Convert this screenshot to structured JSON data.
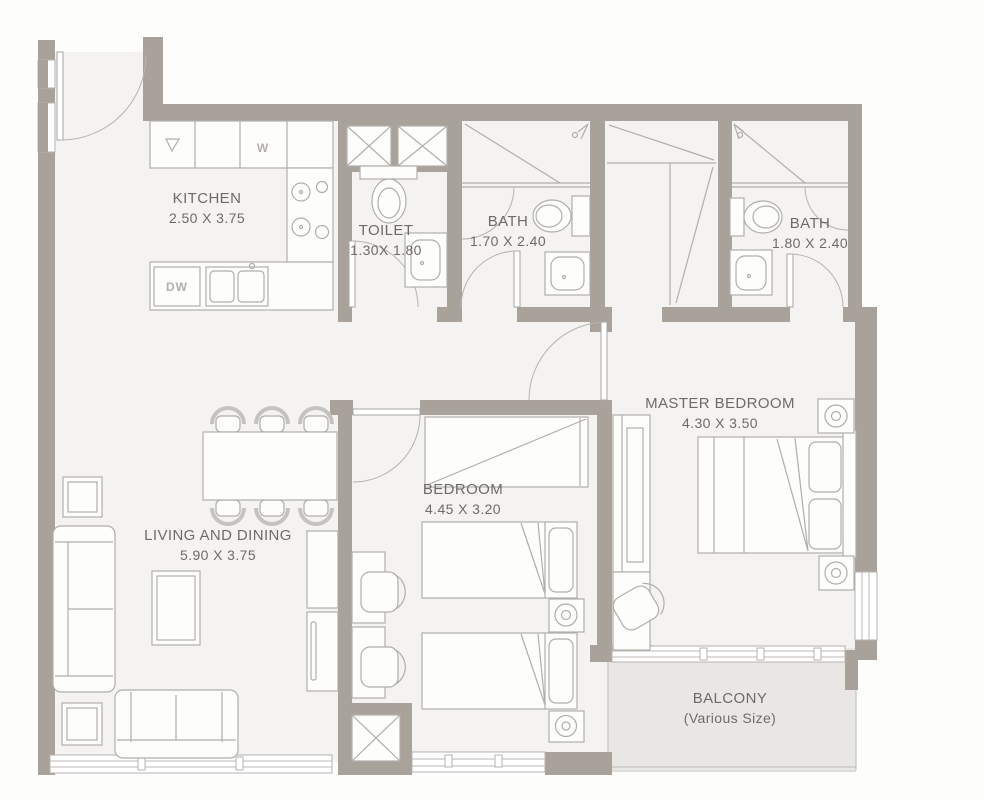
{
  "rooms": {
    "kitchen": {
      "name": "KITCHEN",
      "dims": "2.50 X 3.75"
    },
    "toilet": {
      "name": "TOILET",
      "dims": "1.30X 1.80"
    },
    "bath1": {
      "name": "BATH",
      "dims": "1.70 X 2.40"
    },
    "bath2": {
      "name": "BATH",
      "dims": "1.80 X 2.40"
    },
    "master_bedroom": {
      "name": "MASTER BEDROOM",
      "dims": "4.30 X 3.50"
    },
    "bedroom": {
      "name": "BEDROOM",
      "dims": "4.45 X 3.20"
    },
    "living_dining": {
      "name": "LIVING AND DINING",
      "dims": "5.90 X 3.75"
    },
    "balcony": {
      "name": "BALCONY",
      "dims": "(Various Size)"
    }
  },
  "appliances": {
    "dishwasher": "DW",
    "washer": "W"
  },
  "colors": {
    "wall": "#a9a29a",
    "floor": "#f4f3f1",
    "balcony_floor": "#e9e7e4",
    "fixture_line": "#b1aeaa",
    "label_text": "#6e6c68"
  }
}
